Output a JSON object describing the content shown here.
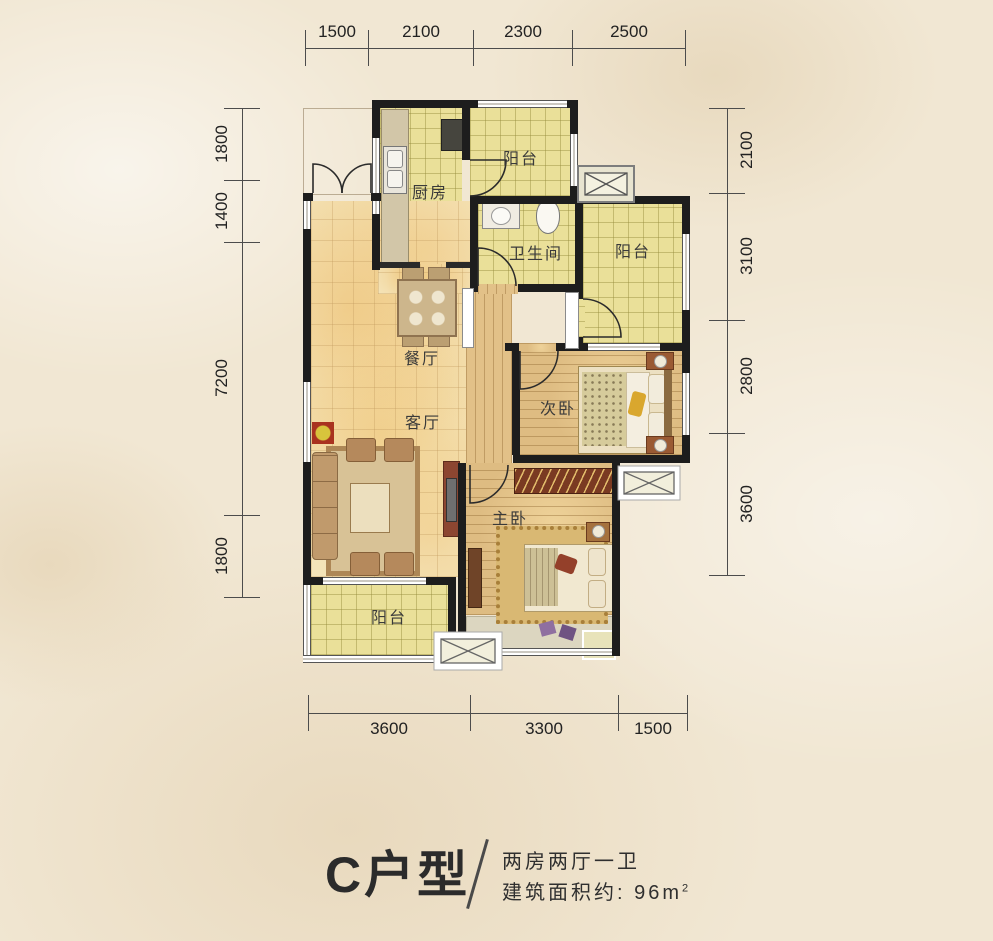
{
  "title": {
    "name": "C户型",
    "separator": "/",
    "layout": "两房两厅一卫",
    "area_prefix": "建筑面积约: 96m",
    "area_sup": "2"
  },
  "dimensions": {
    "top": [
      "1500",
      "2100",
      "2300",
      "2500"
    ],
    "bottom": [
      "3600",
      "3300",
      "1500"
    ],
    "left": [
      "1800",
      "1400",
      "7200",
      "1800"
    ],
    "right": [
      "2100",
      "3100",
      "2800",
      "3600"
    ]
  },
  "rooms": {
    "kitchen": "厨房",
    "balcony_top": "阳台",
    "bathroom": "卫生间",
    "balcony_right": "阳台",
    "dining": "餐厅",
    "living": "客厅",
    "bedroom_second": "次卧",
    "bedroom_master": "主卧",
    "balcony_bottom": "阳台"
  },
  "colors": {
    "wall": "#1d1d1d",
    "tile_floor": "#eae099",
    "wood_floor": "#debc82",
    "background": "#f1e7d3",
    "text": "#2b2b2b"
  }
}
